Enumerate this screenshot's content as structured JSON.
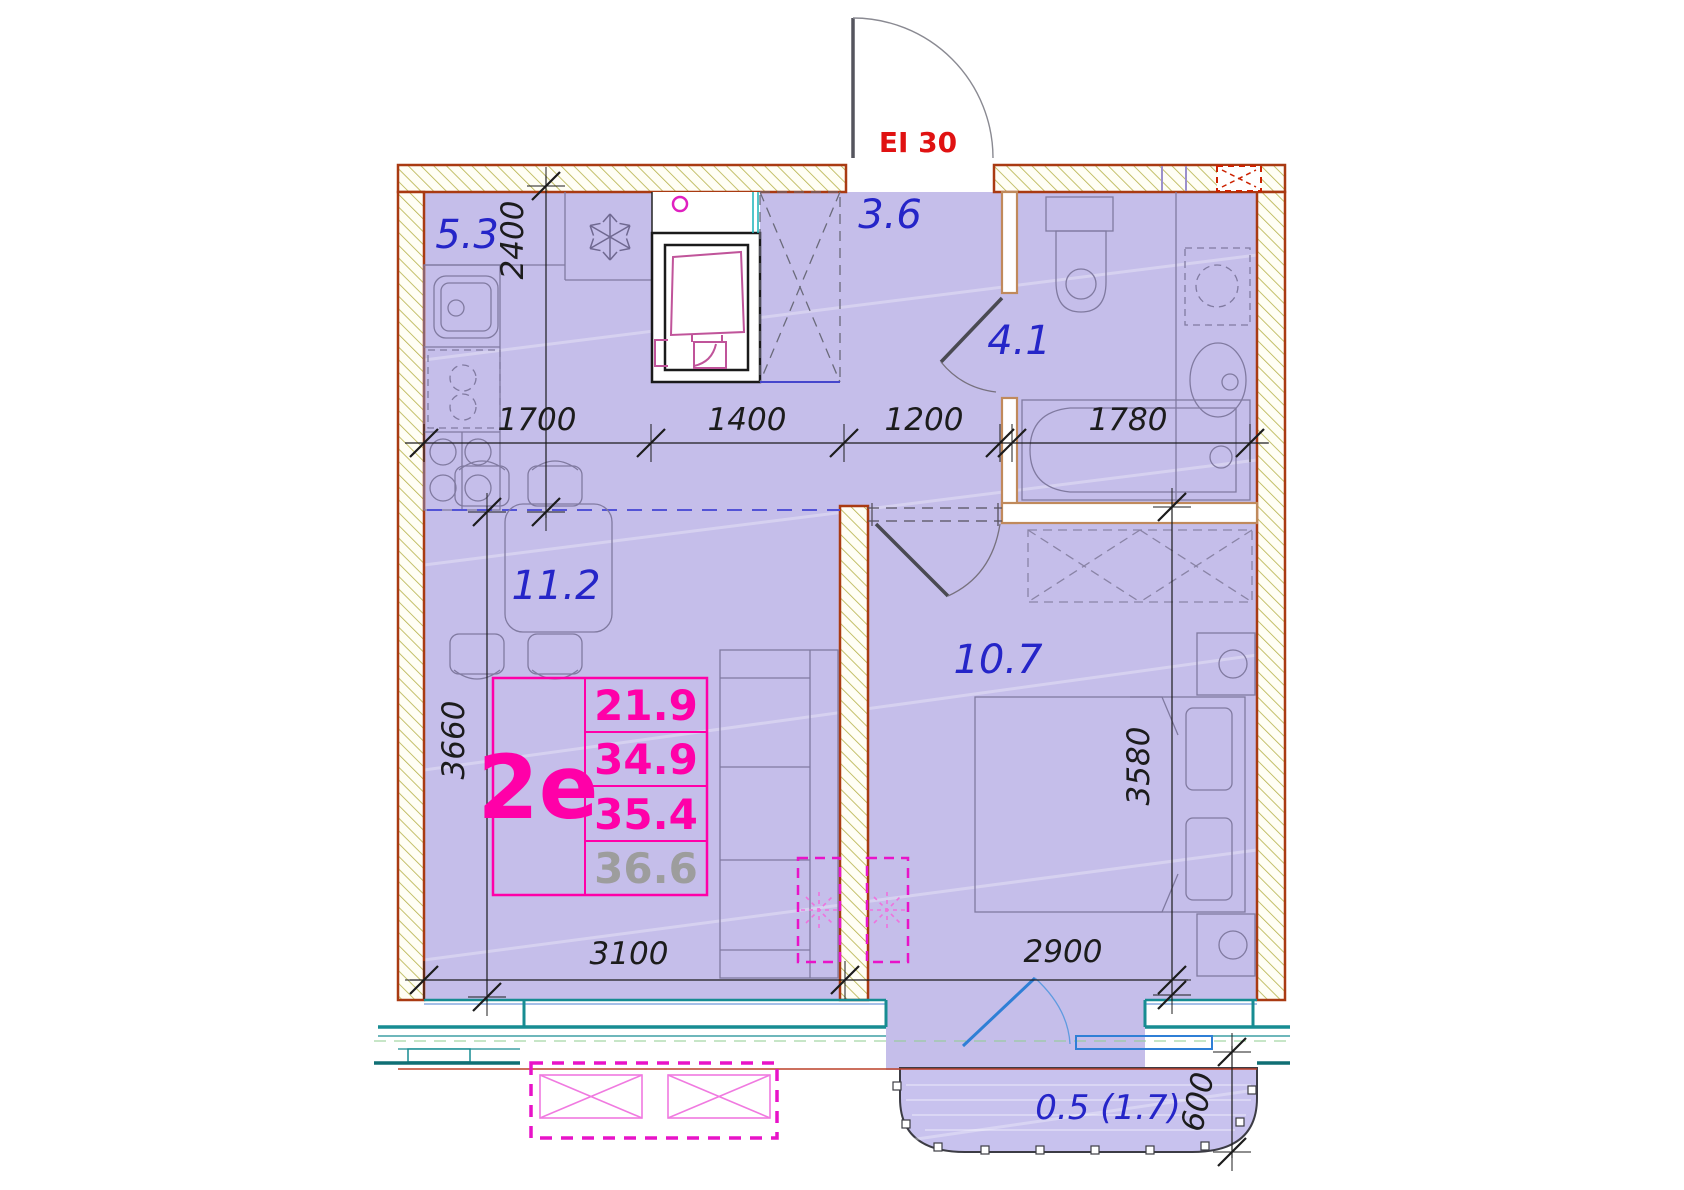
{
  "door": {
    "fire_rating": "EI 30"
  },
  "rooms": {
    "kitchen": {
      "area": "5.3"
    },
    "hallway": {
      "area": "3.6"
    },
    "bathroom": {
      "area": "4.1"
    },
    "living": {
      "area": "11.2"
    },
    "bedroom": {
      "area": "10.7"
    },
    "balcony": {
      "area": "0.5 (1.7)"
    }
  },
  "info_box": {
    "type": "2е",
    "rows": [
      "21.9",
      "34.9",
      "35.4",
      "36.6"
    ]
  },
  "dimensions": {
    "top": [
      "1700",
      "1400",
      "1200",
      "1780"
    ],
    "left_upper": "2400",
    "left_lower": "3660",
    "right_bedroom": "3580",
    "bottom_left": "3100",
    "bottom_right": "2900",
    "balcony_depth": "600"
  },
  "icons": {
    "fridge": "snowflake-icon",
    "ac_indoor": "dashed-star-icon",
    "ac_outdoor": "crossed-box-icon",
    "vent_shaft": "crossed-duct-icon"
  },
  "colors": {
    "floor": "#c5beea",
    "wall_edge": "#a93a12",
    "hatch": "#b5b148",
    "window_teal": "#178c92",
    "partition_tan": "#c08a5c",
    "label_blue": "#2525c8",
    "accent_magenta": "#ff00a8",
    "fire_red": "#e01212",
    "balcony_door_blue": "#2f7fd6",
    "dim_black": "#1c1c1c",
    "muted_gray": "#9d9d9d"
  }
}
